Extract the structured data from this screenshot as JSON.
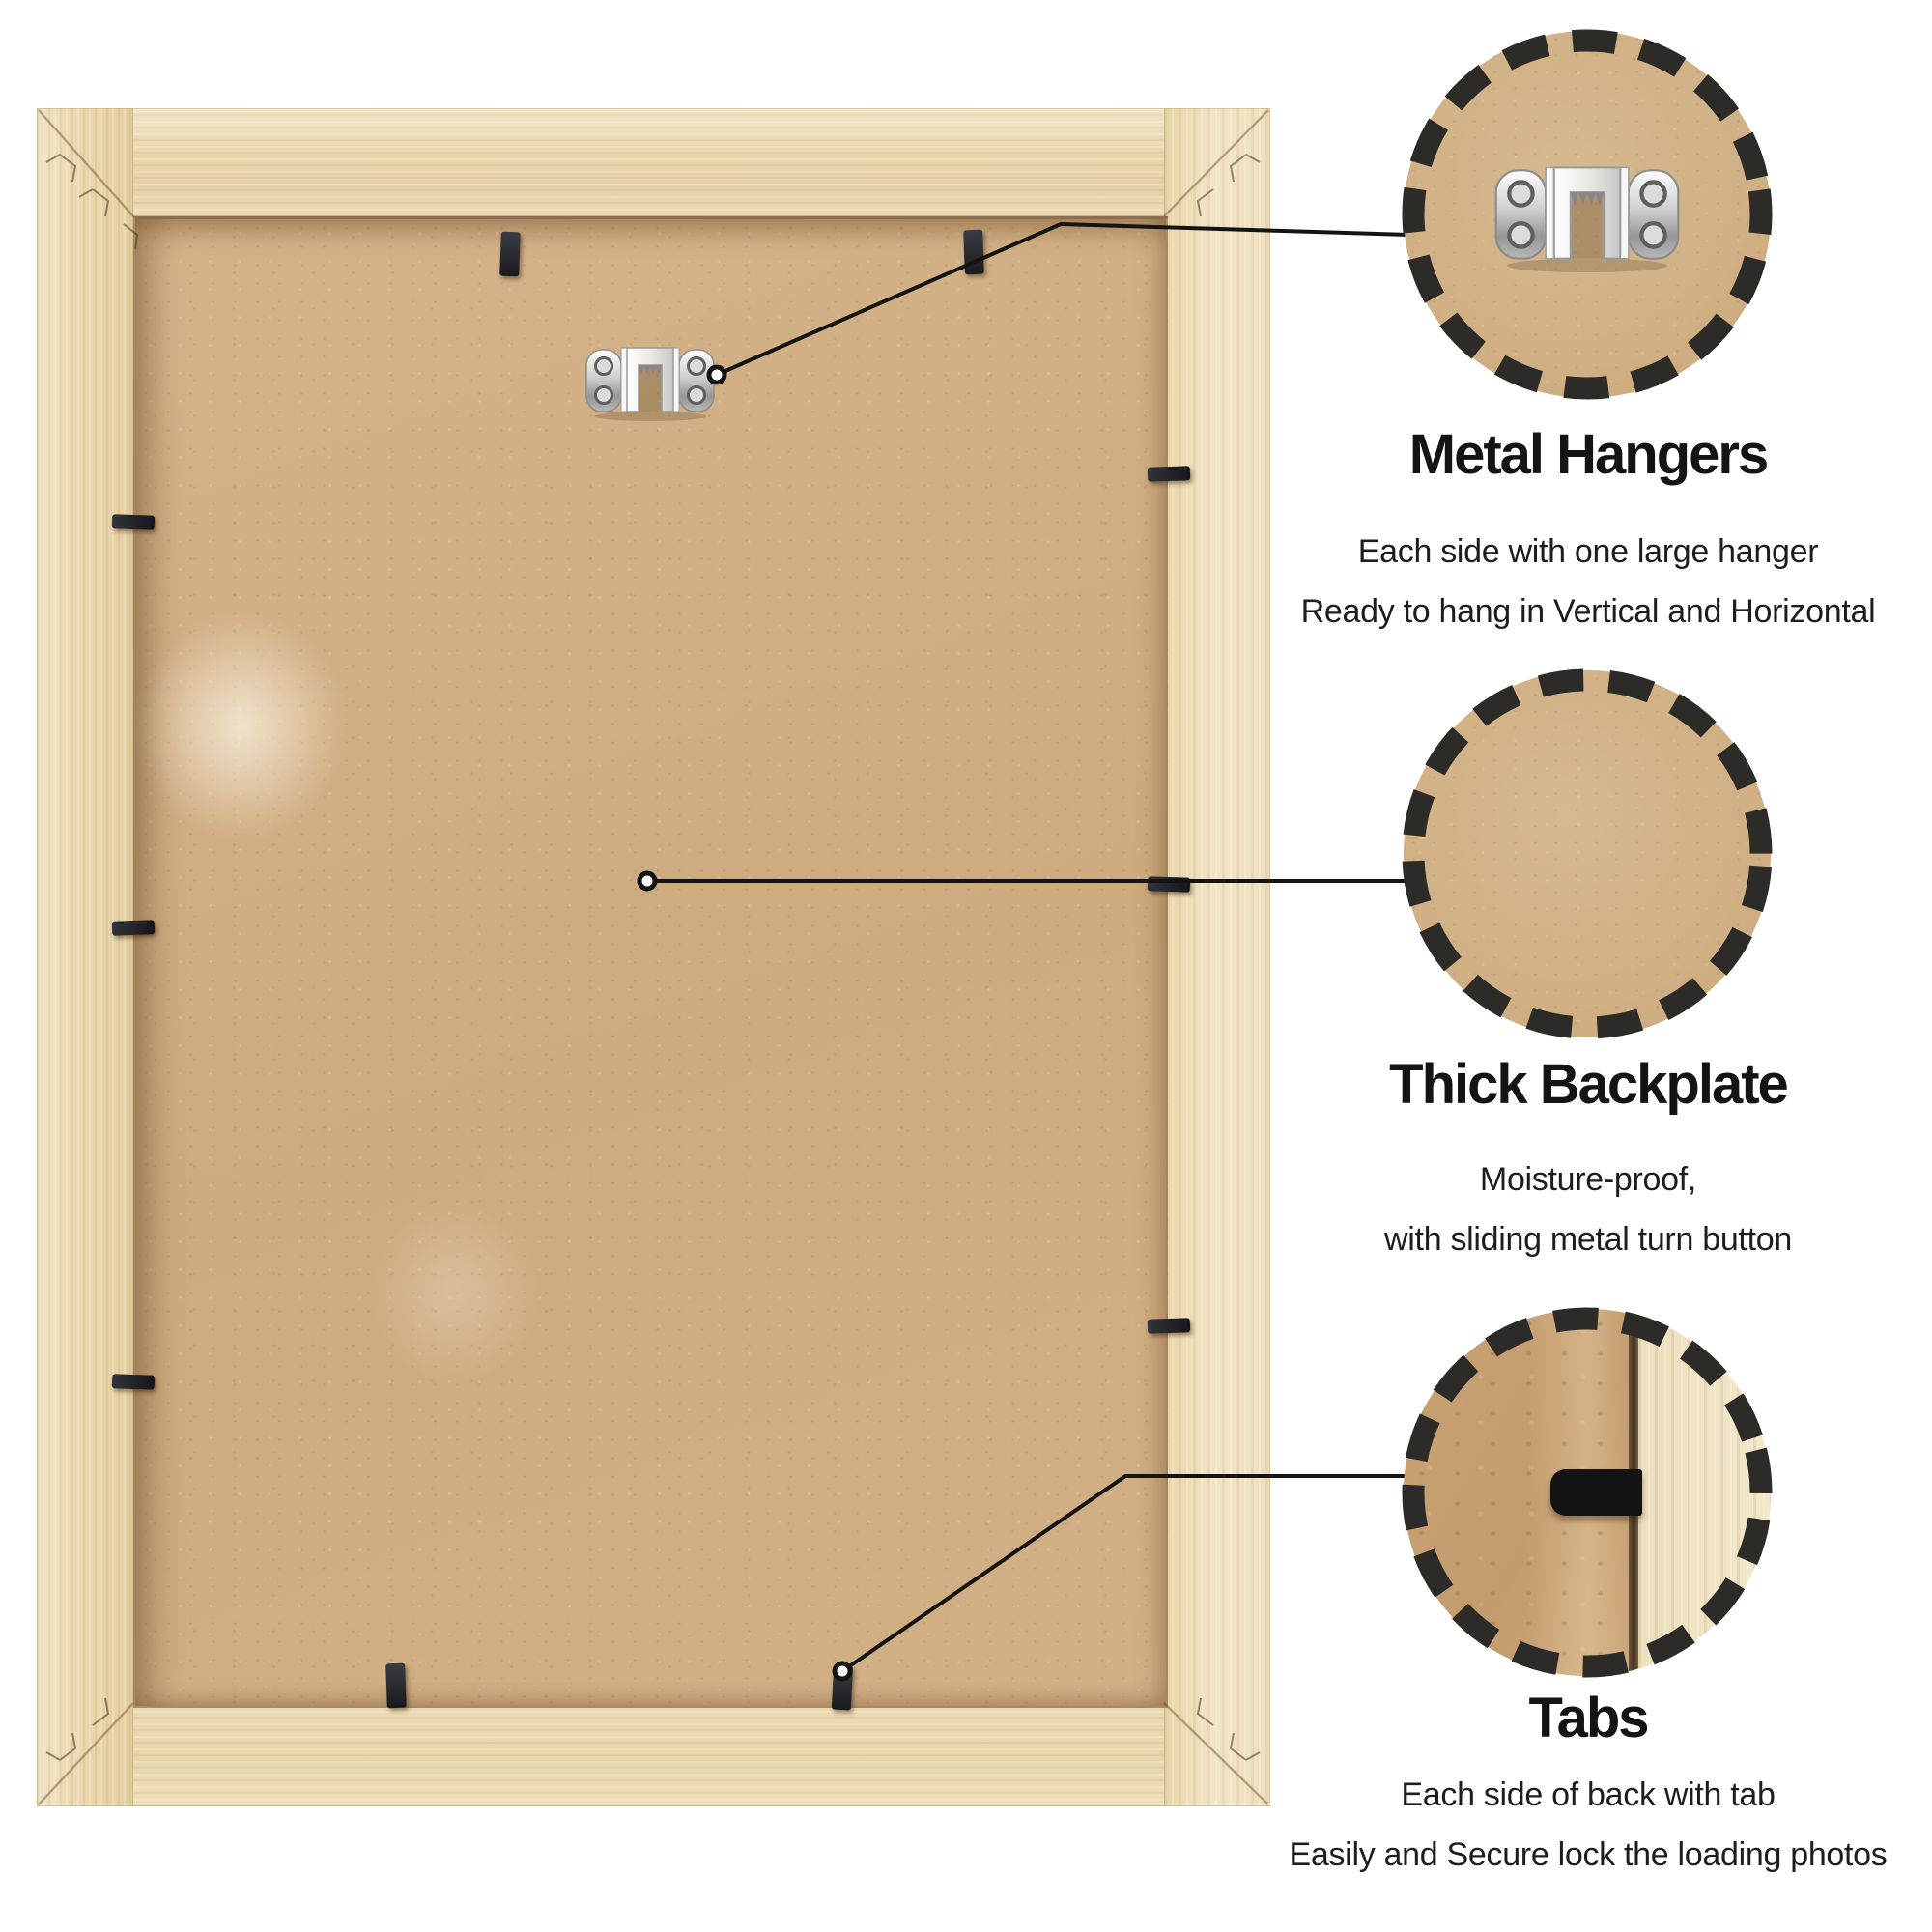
{
  "colors": {
    "background": "#ffffff",
    "frame_wood": "#ebd9b2",
    "backboard": "#d0ae83",
    "retainer_tab": "#232227",
    "callout_ring": "#2d2b28",
    "callout_line": "#141414",
    "text": "#161616"
  },
  "callouts": [
    {
      "id": "metal-hangers",
      "title": "Metal Hangers",
      "lines": [
        "Each side with one large hanger",
        "Ready to hang in Vertical and Horizontal"
      ]
    },
    {
      "id": "thick-backplate",
      "title": "Thick Backplate",
      "lines": [
        "Moisture-proof,",
        "with sliding metal turn button"
      ]
    },
    {
      "id": "tabs",
      "title": "Tabs",
      "lines": [
        "Each side of back with tab",
        "Easily and Secure lock the loading photos"
      ]
    }
  ]
}
